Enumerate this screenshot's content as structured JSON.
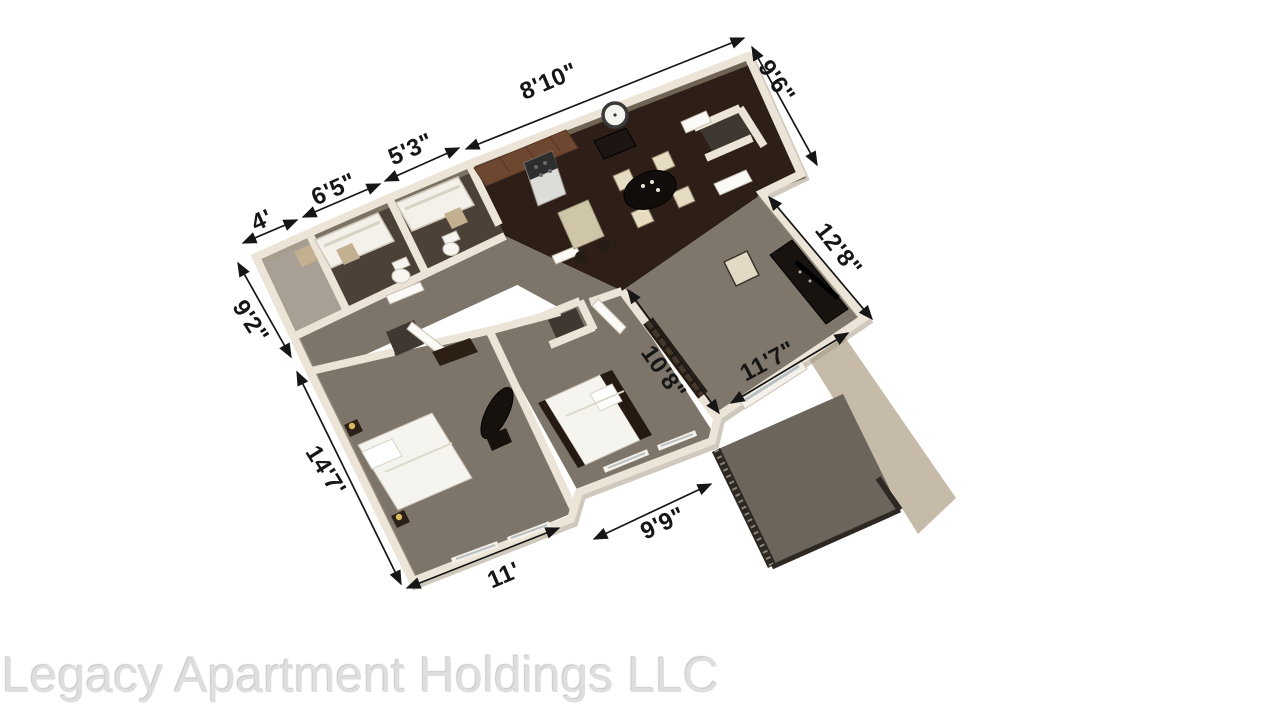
{
  "watermark": {
    "text": "Legacy Apartment Holdings LLC"
  },
  "floorplan": {
    "type": "3d-apartment-floor-plan",
    "dimensions": [
      {
        "id": "top-closet-width",
        "label": "4'",
        "side": "top-left"
      },
      {
        "id": "bathroom1-width",
        "label": "6'5\"",
        "side": "top-left"
      },
      {
        "id": "bathroom2-width",
        "label": "5'3\"",
        "side": "top-left"
      },
      {
        "id": "kitchen-dining-width",
        "label": "8'10\"",
        "side": "top"
      },
      {
        "id": "entry-depth",
        "label": "9'6\"",
        "side": "top-right"
      },
      {
        "id": "living-room-depth",
        "label": "12'8\"",
        "side": "right"
      },
      {
        "id": "bath-wall-depth",
        "label": "9'2\"",
        "side": "left"
      },
      {
        "id": "bedroom1-depth",
        "label": "14'7'",
        "side": "left"
      },
      {
        "id": "bedroom1-width",
        "label": "11'",
        "side": "bottom"
      },
      {
        "id": "bedroom2-width",
        "label": "9'9\"",
        "side": "bottom"
      },
      {
        "id": "hall-wall-length",
        "label": "10'8\"",
        "side": "interior"
      },
      {
        "id": "living-room-width",
        "label": "11'7\"",
        "side": "interior"
      }
    ],
    "colors": {
      "wall": "#ece5d7",
      "wood_floor": "#2d1f18",
      "carpet": "#7d746a",
      "bath_tile": "#4b4138",
      "patio_floor": "#6b655c",
      "dimension_text": "#161616",
      "watermark_gray": "#dedede"
    }
  }
}
